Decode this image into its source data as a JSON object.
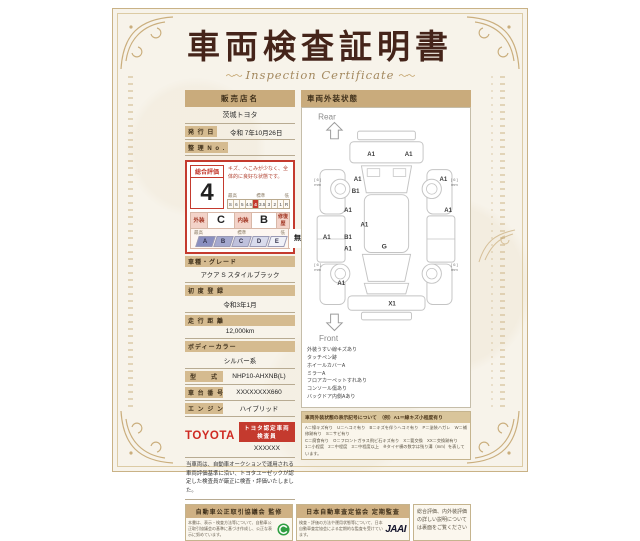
{
  "title": {
    "main": "車両検査証明書",
    "sub": "Inspection Certificate"
  },
  "dealer": {
    "header": "販売店名",
    "name": "茨城トヨタ",
    "issue_label": "発 行 日",
    "issue_value": "令和 7年10月26日",
    "ref_label": "整 理 N o .",
    "ref_value": ""
  },
  "evaluation": {
    "label": "総合評価",
    "score": "4",
    "comment": "キズ、へこみが少なく、全体的に良好な状態です。",
    "scale_labels": {
      "high": "最高",
      "mid": "標準",
      "low": "低"
    },
    "scale": [
      "S",
      "6",
      "5",
      "4.5",
      "4",
      "3.5",
      "3",
      "2",
      "1",
      "R"
    ],
    "scale_selected": "4",
    "exterior_label": "外装",
    "exterior_grade": "C",
    "interior_label": "内装",
    "interior_grade": "B",
    "repair_label": "修復歴",
    "repair_value": "無",
    "letter_scale": [
      "A",
      "B",
      "C",
      "D",
      "E"
    ]
  },
  "fields": [
    {
      "label": "車種・グレード",
      "value": "アクア S スタイルブラック",
      "stacked": true
    },
    {
      "label": "初 度 登 録",
      "value": "令和3年1月",
      "stacked": true
    },
    {
      "label": "走 行 距 離",
      "value": "12,000km",
      "stacked": true
    },
    {
      "label": "ボディーカラー",
      "value": "シルバー系",
      "stacked": true
    },
    {
      "label": "型　　式",
      "value": "NHP10-AHXNB(L)",
      "stacked": false
    },
    {
      "label": "車 台 番 号",
      "value": "XXXXXXXX660",
      "stacked": false
    },
    {
      "label": "エ ン ジ ン",
      "value": "ハイブリッド",
      "stacked": false
    }
  ],
  "inspector": {
    "brand": "TOYOTA",
    "badge": "トヨタ認定車両検査員",
    "number": "XXXXXX",
    "statement": "当車両は、自動車オークションで運用される車両評価基準に沿い、トヨタユーゼックが認定した検査員が厳正に検査・評価いたしました。"
  },
  "exterior": {
    "header": "車両外装状態",
    "rear_label": "Rear",
    "front_label": "Front",
    "markers": [
      {
        "x": 58,
        "y": 50,
        "t": "A1"
      },
      {
        "x": 97,
        "y": 50,
        "t": "A1"
      },
      {
        "x": 44,
        "y": 76,
        "t": "A1"
      },
      {
        "x": 42,
        "y": 88,
        "t": "B1"
      },
      {
        "x": 133,
        "y": 76,
        "t": "A1"
      },
      {
        "x": 34,
        "y": 108,
        "t": "A1"
      },
      {
        "x": 138,
        "y": 108,
        "t": "A1"
      },
      {
        "x": 51,
        "y": 123,
        "t": "A1"
      },
      {
        "x": 12,
        "y": 136,
        "t": "A1"
      },
      {
        "x": 34,
        "y": 136,
        "t": "B1"
      },
      {
        "x": 34,
        "y": 148,
        "t": "A1"
      },
      {
        "x": 73,
        "y": 146,
        "t": "G"
      },
      {
        "x": 27,
        "y": 184,
        "t": "A1"
      },
      {
        "x": 80,
        "y": 205,
        "t": "X1"
      }
    ],
    "tires": {
      "value": "[ 6 ]",
      "unit": "mm",
      "positions": [
        {
          "x": 3,
          "y": 76
        },
        {
          "x": 152,
          "y": 76,
          "end": true
        },
        {
          "x": 3,
          "y": 164
        },
        {
          "x": 152,
          "y": 164,
          "end": true
        }
      ]
    },
    "notes": [
      "外装うすい線キズあり",
      "タッチペン跡",
      "ホイールカバーA",
      "ミラーA",
      "フロアカーペットすれあり",
      "コンソール傷あり",
      "バックドア内側Aあり"
    ],
    "legend": {
      "header": "車両外装状態の表示記号について　（例）A1＝線キズ小程度有り",
      "lines": [
        "A＝線キズ有り　U＝ヘコミ有り　B＝キズを伴うヘコミ有り　P＝塗装ハガレ　W＝補修跡有り　S＝サビ有り",
        "C＝腐食有り　O＝フロントガラス飛ビ石キズ有り　X＝要交換　XX＝交換跡有り",
        "1＝小程度　2＝中程度　3＝中程度以上　※タイヤ横の数字は残り溝（mm）を表しています。"
      ]
    }
  },
  "footer": {
    "left": {
      "header": "自動車公正取引協議会 監修",
      "text": "本書は、表示・検査方法等について、自動車公正取引協議会の基準に基づき作成し、公正な表示に努めています。"
    },
    "right": {
      "header": "日本自動車査定協会 定期監査",
      "text": "検査・評価の方法や運用状態等について、日本自動車査定協会による定期的な監査を受けています。",
      "logo": "JAAI"
    },
    "note": "総合評価、内外装評価の詳しい説明については裏面をご覧ください"
  },
  "colors": {
    "accent_red": "#c43a2e",
    "tan_bar": "#c9ab7c",
    "title_maroon": "#45241a",
    "gold_border": "#c3a36b",
    "green_logo": "#2f9e41"
  }
}
